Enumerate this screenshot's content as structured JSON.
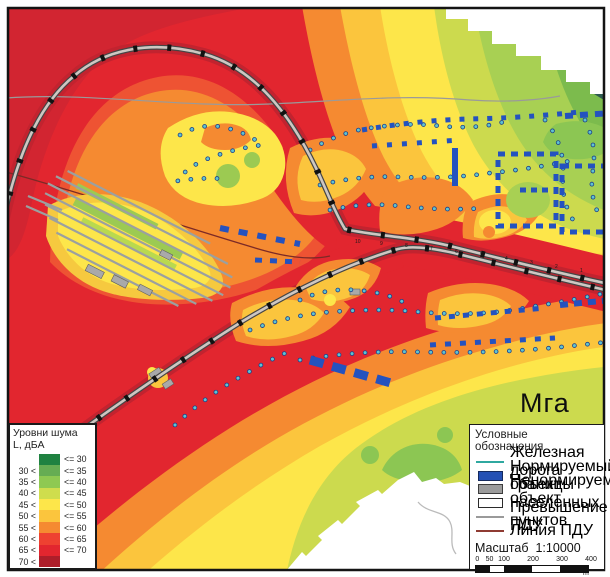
{
  "map": {
    "town_label": "Мга",
    "km_labels": [
      "10",
      "9",
      "8",
      "7",
      "6",
      "5",
      "4",
      "3",
      "2",
      "1"
    ]
  },
  "palette": {
    "le30": "#1f8241",
    "le35": "#66ad53",
    "le40": "#8ec952",
    "le45": "#cfdd4d",
    "le50": "#fde64a",
    "le55": "#fbc53d",
    "le60": "#f58a31",
    "le65": "#ee4131",
    "le70": "#e2262f",
    "gt70": "#ad1e2a"
  },
  "noise_legend": {
    "title_line1": "Уровни шума",
    "title_line2": "L, дБА",
    "levels": [
      30,
      35,
      40,
      45,
      50,
      55,
      60,
      65,
      70
    ],
    "colors": [
      "#1f8241",
      "#66ad53",
      "#8ec952",
      "#cfdd4d",
      "#fde64a",
      "#fbc53d",
      "#f58a31",
      "#ee4131",
      "#e2262f",
      "#ad1e2a"
    ]
  },
  "symbols_legend": {
    "title": "Условные обозначения",
    "items": [
      {
        "icon": "railway-line-icon",
        "swatch": "line",
        "color": "#2fa8a0",
        "label": "Железная дорога"
      },
      {
        "icon": "normalized-object-icon",
        "swatch": "rect",
        "color": "#2450b4",
        "border": "#152a5e",
        "label": "Нормируемый объект"
      },
      {
        "icon": "nonnormalized-object-icon",
        "swatch": "rect",
        "color": "#9c9c9c",
        "border": "#3d3d3d",
        "label": "Ненормируемый объект"
      },
      {
        "icon": "settlement-boundary-icon",
        "swatch": "rect",
        "color": "#ffffff",
        "border": "#2b2b2b",
        "label": "Границы населенных пунктов"
      },
      {
        "icon": "exceedance-line-icon",
        "swatch": "line",
        "color": "#9a9a9a",
        "label": "Превышение ПДУ"
      },
      {
        "icon": "mpl-line-icon",
        "swatch": "line",
        "color": "#8f3b32",
        "label": "Линия ПДУ"
      }
    ],
    "scale": {
      "word": "Масштаб",
      "ratio": "1:10000",
      "ticks": [
        "0",
        "50",
        "100",
        "200",
        "300",
        "400"
      ],
      "unit": "m"
    }
  }
}
